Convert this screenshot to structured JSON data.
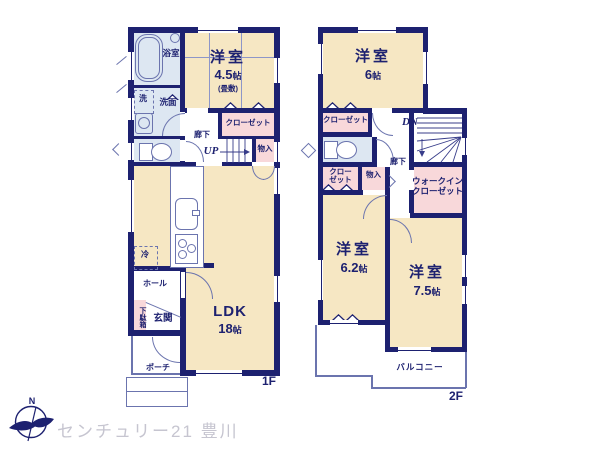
{
  "colors": {
    "wall": "#1d2170",
    "ink": "#1d2170",
    "cream": "#f6e7c3",
    "pink": "#f8d8da",
    "blue": "#dde7f2",
    "line": "#8d96c8",
    "thin": "#6b74ae",
    "gray": "#c6c5d0"
  },
  "floor1": {
    "label": "1F",
    "bath": "浴室",
    "washer": "洗",
    "washroom": "洗面",
    "room45": "洋室",
    "room45_num": "4.5",
    "room45_unit": "帖",
    "room45_note": "(畳敷)",
    "closet": "クローゼット",
    "hallway": "廊下",
    "up": "UP",
    "storage": "物入",
    "ldk": "LDK",
    "ldk_num": "18",
    "ldk_unit": "帖",
    "fridge": "冷",
    "hall": "ホール",
    "shoebox": "下駄箱",
    "entrance": "玄関",
    "porch": "ポーチ"
  },
  "floor2": {
    "label": "2F",
    "room6": "洋室",
    "room6_num": "6",
    "room6_unit": "帖",
    "closet1": "クローゼット",
    "dn": "DN",
    "closet2a": "クロー",
    "closet2b": "ゼット",
    "storage": "物入",
    "hallway": "廊下",
    "wic1": "ウォークイン",
    "wic2": "クローゼット",
    "room62": "洋室",
    "room62_num": "6.2",
    "room62_unit": "帖",
    "room75": "洋室",
    "room75_num": "7.5",
    "room75_unit": "帖",
    "balcony": "バルコニー"
  },
  "footer": {
    "compass_n": "N",
    "brand": "センチュリー21 豊川"
  }
}
